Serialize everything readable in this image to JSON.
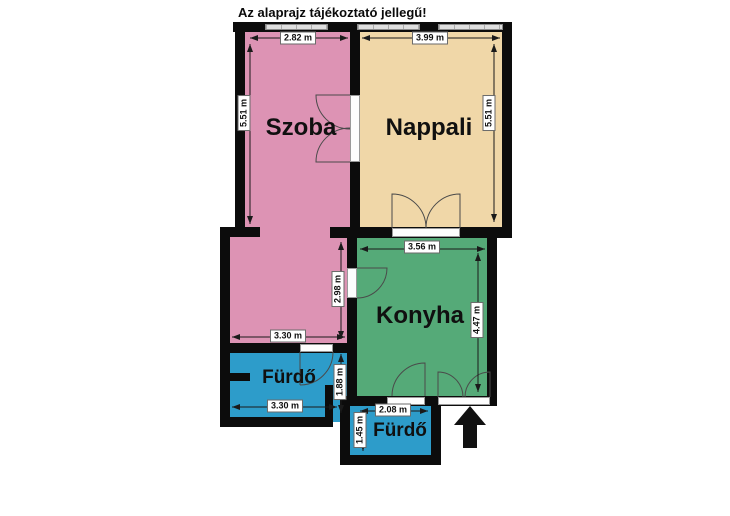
{
  "title": "Az alaprajz tájékoztató jellegű!",
  "rooms": {
    "szoba": {
      "label": "Szoba"
    },
    "nappali": {
      "label": "Nappali"
    },
    "konyha": {
      "label": "Konyha"
    },
    "furdo_large": {
      "label": "Fürdő"
    },
    "furdo_small": {
      "label": "Fürdő"
    }
  },
  "dimensions": {
    "szoba_width": "2.82 m",
    "szoba_height": "5.51 m",
    "nappali_width": "3.99 m",
    "nappali_height": "5.51 m",
    "konyha_width": "3.56 m",
    "konyha_height": "4.47 m",
    "hall_width": "3.30 m",
    "hall_height": "2.98 m",
    "furdo_large_width": "3.30 m",
    "furdo_large_height": "1.88 m",
    "furdo_small_width": "2.08 m",
    "furdo_small_height": "1.45 m"
  },
  "colors": {
    "szoba": "#dd93b4",
    "nappali": "#f0d7a8",
    "konyha": "#55aa78",
    "furdo": "#2d9cca",
    "wall": "#0c0c0c",
    "window": "#dedede",
    "entrance_arrow": "#111111"
  }
}
